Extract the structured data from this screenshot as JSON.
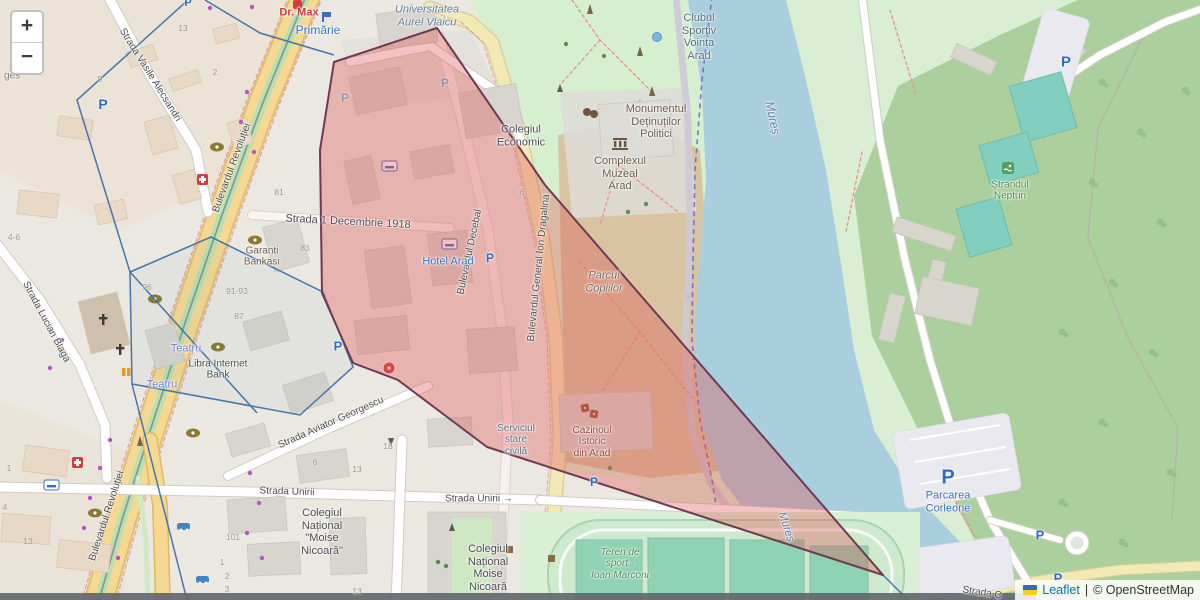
{
  "controls": {
    "zoom_in": "+",
    "zoom_out": "−"
  },
  "attribution": {
    "leaflet_link": "Leaflet",
    "separator": "|",
    "osm_text": "© OpenStreetMap"
  },
  "icons": {
    "parking_label": "P"
  },
  "streets": {
    "vasile_alecsandri": "Strada Vasile Alecsandri",
    "revolutiei": "Bulevardul Revoluției",
    "decembrie": "Strada 1 Decembrie 1918",
    "decebal": "Bulevardul Decebal",
    "dragalina": "Bulevardul General Ion Dragalina",
    "lucian_blaga": "Strada Lucian Blaga",
    "aviator_georgescu": "Strada Aviator Georgescu",
    "unirii": "Strada Unirii",
    "unirii_arrow": "Strada Unirii →",
    "strada_c": "Strada C",
    "ges": "ges"
  },
  "places": {
    "dr_max": "Dr. Max",
    "primarie": "Primărie",
    "universitatea": "Universitatea\nAurel Vlaicu",
    "clubul_sportiv": "Clubul\nSportiv\nVoința\nArad",
    "colegiul_economic": "Colegiul\nEconomic",
    "monumentul": "Monumentul\nDeținuților\nPolitici",
    "complexul": "Complexul\nMuzeal\nArad",
    "parcul_copiilor": "Parcul\nCopiilor",
    "hotel_arad": "Hotel Arad",
    "garanti": "Garanti\nBankası",
    "teatru": "Teatru",
    "libra": "Libra Internet\nBank",
    "serviciul": "Serviciul\nstare\ncivilă",
    "cazinoul": "Cazinoul\nIstoric\ndin Arad",
    "colegiul_moise_quoted": "Colegiul\nNațional\n\"Moise\nNicoară\"",
    "colegiul_moise": "Colegiul\nNațional\nMoise\nNicoară",
    "teren_sport": "Teren de\nsport ·\nIoan Marconi",
    "strandul": "Ștrandul\nNeptun",
    "parcarea": "Parcarea\nCorleone",
    "mures": "Mureș"
  },
  "housenumbers": [
    "13",
    "2",
    "9",
    "4-6",
    "96",
    "91-93",
    "87",
    "83",
    "81",
    "6",
    "18",
    "6",
    "13",
    "101",
    "1",
    "2",
    "3",
    "1",
    "4",
    "13",
    "13"
  ],
  "colors": {
    "selection_fill": "#e05656",
    "selection_stroke": "#6d3a52",
    "route_outline_blue": "#3f6fa5",
    "water": "#a9cedd",
    "forest": "#accf9e",
    "park": "#d6efcf",
    "road_primary": "#f6d892",
    "link_blue": "#0078a8"
  }
}
